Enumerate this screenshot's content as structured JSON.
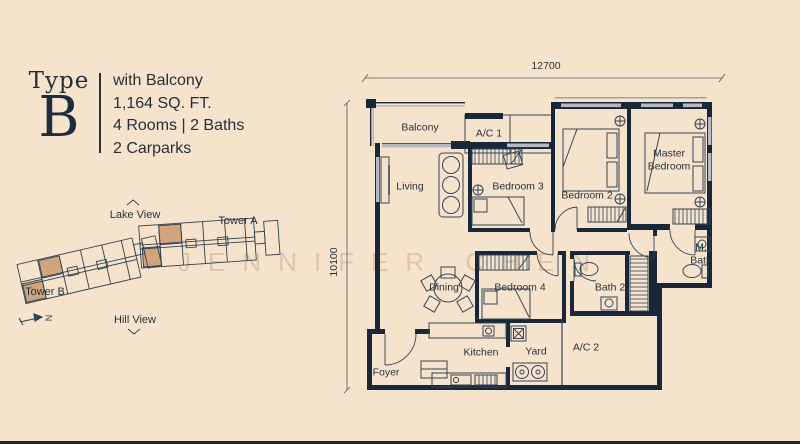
{
  "unit": {
    "type_label": "Type",
    "type_letter": "B",
    "details": [
      "with Balcony",
      "1,164 SQ. FT.",
      "4 Rooms | 2 Baths",
      "2 Carparks"
    ]
  },
  "site_plan": {
    "lake_view": "Lake View",
    "hill_view": "Hill View",
    "tower_a": "Tower A",
    "tower_b": "Tower B",
    "north": "N"
  },
  "floor_plan": {
    "dim_width": "12700",
    "dim_height": "10100",
    "rooms": [
      {
        "id": "balcony",
        "label": "Balcony"
      },
      {
        "id": "ac1",
        "label": "A/C 1"
      },
      {
        "id": "living",
        "label": "Living"
      },
      {
        "id": "bedroom3",
        "label": "Bedroom 3"
      },
      {
        "id": "bedroom2",
        "label": "Bedroom 2"
      },
      {
        "id": "master-bedroom",
        "label": "Master Bedroom"
      },
      {
        "id": "dining",
        "label": "Dining"
      },
      {
        "id": "bedroom4",
        "label": "Bedroom 4"
      },
      {
        "id": "bath2",
        "label": "Bath 2"
      },
      {
        "id": "master-bath",
        "label": "M. Bath"
      },
      {
        "id": "kitchen",
        "label": "Kitchen"
      },
      {
        "id": "yard",
        "label": "Yard"
      },
      {
        "id": "ac2",
        "label": "A/C 2"
      },
      {
        "id": "foyer",
        "label": "Foyer"
      }
    ]
  },
  "watermark": "JENNIFER CHEN",
  "colors": {
    "background": "#f6e3cb",
    "ink": "#20303f",
    "wall": "#16283a",
    "window_gray": "#b6bbc1",
    "highlight_tan": "#d2a47c"
  }
}
